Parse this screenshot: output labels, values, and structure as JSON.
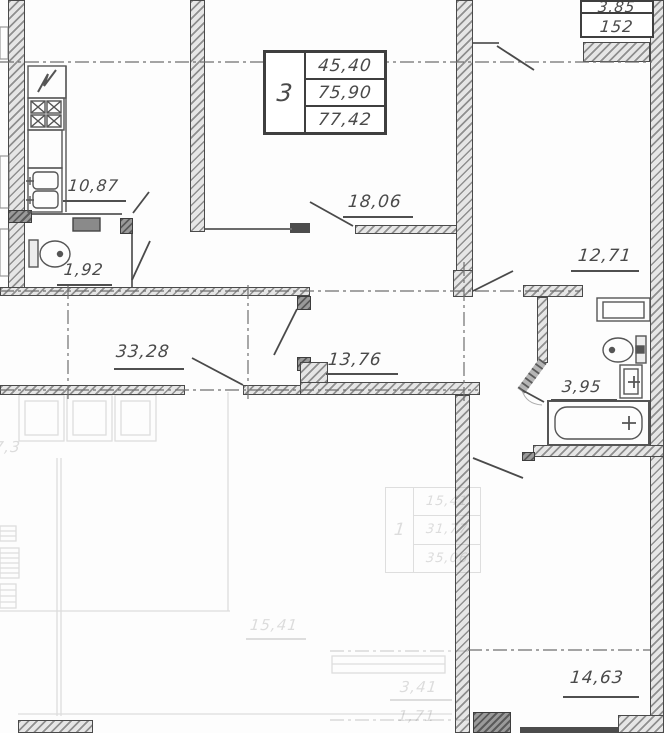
{
  "title": "Apartment floor plan",
  "apartment_box": {
    "rooms": "3",
    "living_area": "45,40",
    "apartment_area": "75,90",
    "total_area": "77,42"
  },
  "balcony_box": {
    "upper": "3,85",
    "lower": "152"
  },
  "labels": {
    "kitchen": "10,87",
    "wc": "1,92",
    "room1": "18,06",
    "room2": "12,71",
    "hall": "33,28",
    "corridor": "13,76",
    "bathroom": "3,95",
    "room3": "14,63"
  },
  "faded": {
    "left_cut": "7,3",
    "room": "15,41",
    "hall_small": "3,41",
    "wc_small": "1,71",
    "box": {
      "rooms": "1",
      "row1": "15,41",
      "row2": "31,77",
      "row3": "35,06"
    }
  }
}
